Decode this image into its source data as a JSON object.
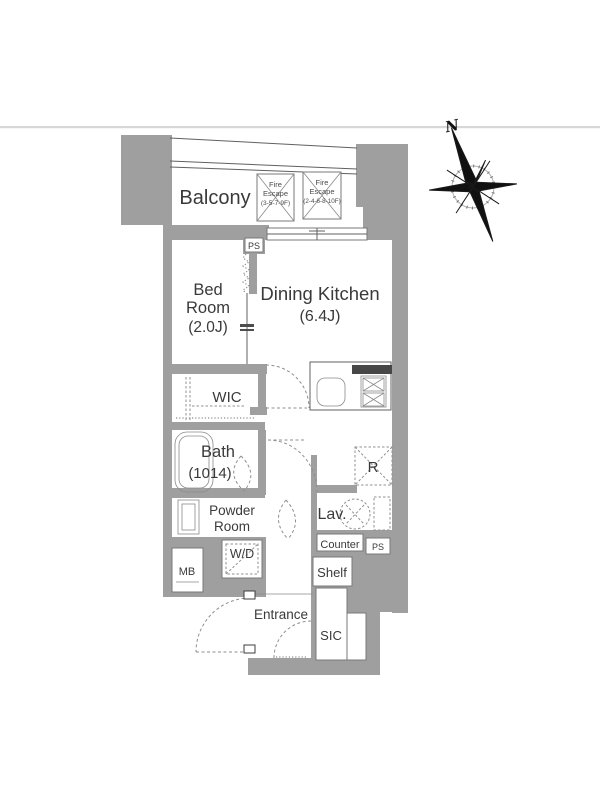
{
  "page": {
    "background_color": "#ffffff",
    "top_divider_color": "#d7d7d7"
  },
  "plan": {
    "wall_color": "#9f9f9f",
    "outline_color": "#606060",
    "text_color": "#3a3a3a",
    "labels": {
      "balcony": "Balcony",
      "bedroom_line1": "Bed",
      "bedroom_line2": "Room",
      "bedroom_size": "(2.0J)",
      "dining_kitchen": "Dining Kitchen",
      "dining_kitchen_size": "(6.4J)",
      "wic": "WIC",
      "bath": "Bath",
      "bath_size": "(1014)",
      "powder_line1": "Powder",
      "powder_line2": "Room",
      "lavatory": "Lav.",
      "entrance": "Entrance",
      "sic": "SIC",
      "wd": "W/D",
      "mb": "MB",
      "counter": "Counter",
      "shelf": "Shelf",
      "refrigerator": "R",
      "ps_top": "PS",
      "ps_bottom": "PS"
    },
    "fire_escape_1": {
      "line1": "Fire",
      "line2": "Escape",
      "line3": "(3-5-7-9F)"
    },
    "fire_escape_2": {
      "line1": "Fire",
      "line2": "Escape",
      "line3": "(2-4-6-8-10F)"
    },
    "compass": {
      "north": "N"
    }
  }
}
